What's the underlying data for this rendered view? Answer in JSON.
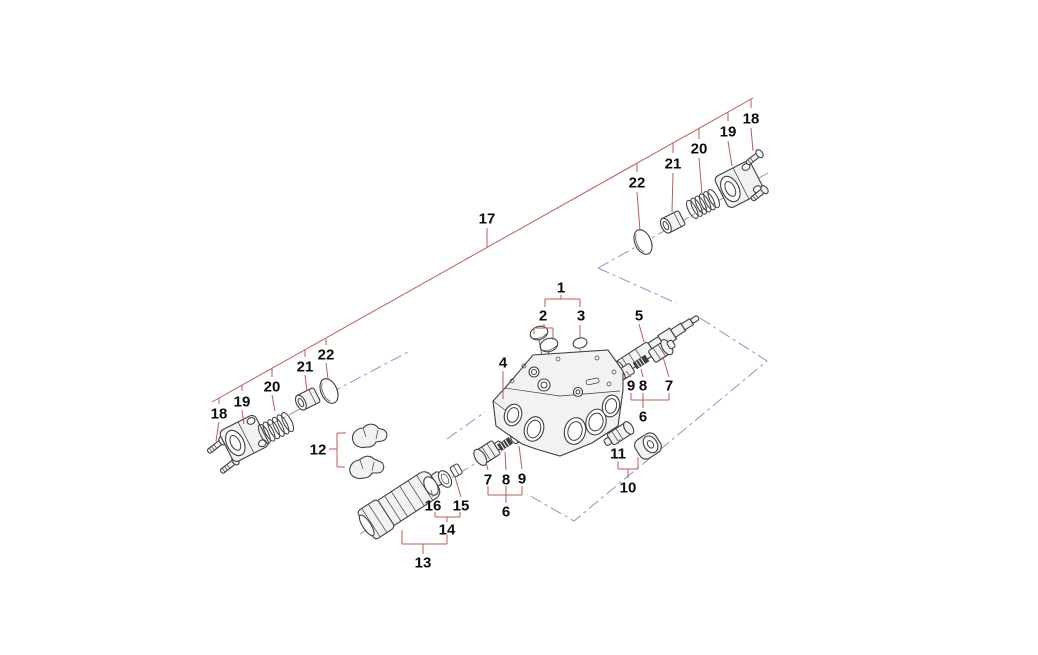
{
  "diagram": {
    "description": "Exploded parts diagram of a hydraulic control valve assembly with numbered callouts",
    "background_color": "#ffffff",
    "colors": {
      "leader_line": "#bb5b56",
      "center_line": "#8f93c4",
      "part_outline": "#3f3f3f",
      "label_text": "#0c0c0c"
    },
    "callouts": [
      {
        "text": "17",
        "x": 487,
        "y": 218
      },
      {
        "text": "1",
        "x": 561,
        "y": 287
      },
      {
        "text": "2",
        "x": 543,
        "y": 315
      },
      {
        "text": "3",
        "x": 581,
        "y": 315
      },
      {
        "text": "4",
        "x": 503,
        "y": 362
      },
      {
        "text": "5",
        "x": 639,
        "y": 315
      },
      {
        "text": "9",
        "x": 631,
        "y": 385
      },
      {
        "text": "8",
        "x": 643,
        "y": 385
      },
      {
        "text": "7",
        "x": 669,
        "y": 385
      },
      {
        "text": "6",
        "x": 643,
        "y": 416
      },
      {
        "text": "11",
        "x": 618,
        "y": 453
      },
      {
        "text": "10",
        "x": 628,
        "y": 487
      },
      {
        "text": "7",
        "x": 488,
        "y": 479
      },
      {
        "text": "8",
        "x": 506,
        "y": 479
      },
      {
        "text": "9",
        "x": 522,
        "y": 478
      },
      {
        "text": "6",
        "x": 506,
        "y": 511
      },
      {
        "text": "12",
        "x": 318,
        "y": 449
      },
      {
        "text": "13",
        "x": 423,
        "y": 562
      },
      {
        "text": "14",
        "x": 447,
        "y": 529
      },
      {
        "text": "16",
        "x": 433,
        "y": 505
      },
      {
        "text": "15",
        "x": 461,
        "y": 505
      },
      {
        "text": "18",
        "x": 219,
        "y": 413
      },
      {
        "text": "19",
        "x": 242,
        "y": 401
      },
      {
        "text": "20",
        "x": 272,
        "y": 386
      },
      {
        "text": "21",
        "x": 305,
        "y": 366
      },
      {
        "text": "22",
        "x": 326,
        "y": 354
      },
      {
        "text": "22",
        "x": 637,
        "y": 182
      },
      {
        "text": "21",
        "x": 673,
        "y": 163
      },
      {
        "text": "20",
        "x": 699,
        "y": 148
      },
      {
        "text": "19",
        "x": 728,
        "y": 131
      },
      {
        "text": "18",
        "x": 751,
        "y": 118
      }
    ]
  }
}
